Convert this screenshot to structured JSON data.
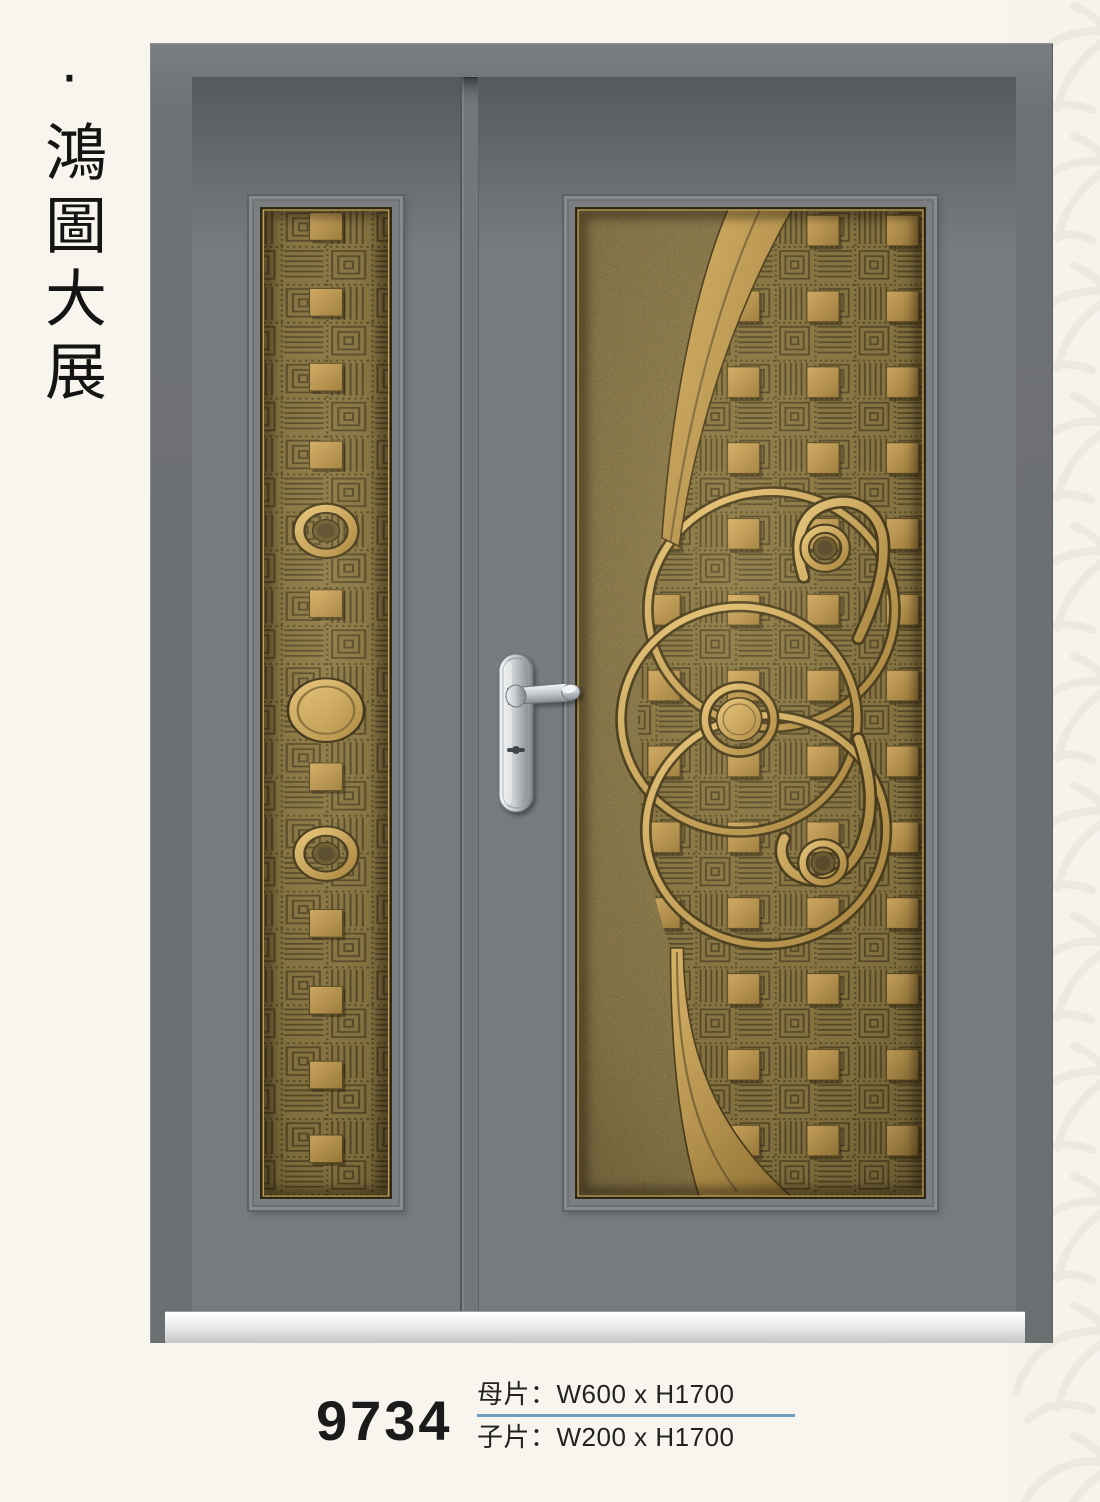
{
  "brand": {
    "text": "·鴻圖大展"
  },
  "product": {
    "model": "9734",
    "specs": [
      {
        "label": "母片",
        "value": "W600 x H1700",
        "text": "母片：W600 x H1700"
      },
      {
        "label": "子片",
        "value": "W200 x H1700",
        "text": "子片：W200 x H1700"
      }
    ]
  },
  "colors": {
    "background_cream": "#f8f5ee",
    "watermark": "#eae6da",
    "door_frame_gray": "#6e7174",
    "door_leaf_gray": "#787b7e",
    "bronze_gold": "#c9a255",
    "bronze_ground": "#8a7844",
    "engraving_dark": "#57492a",
    "handle_silver": "#c9cdd0",
    "sill_silver": "#e9eaeb",
    "divider_blue": "#6e9ec2",
    "text_black": "#1b1b1b"
  }
}
